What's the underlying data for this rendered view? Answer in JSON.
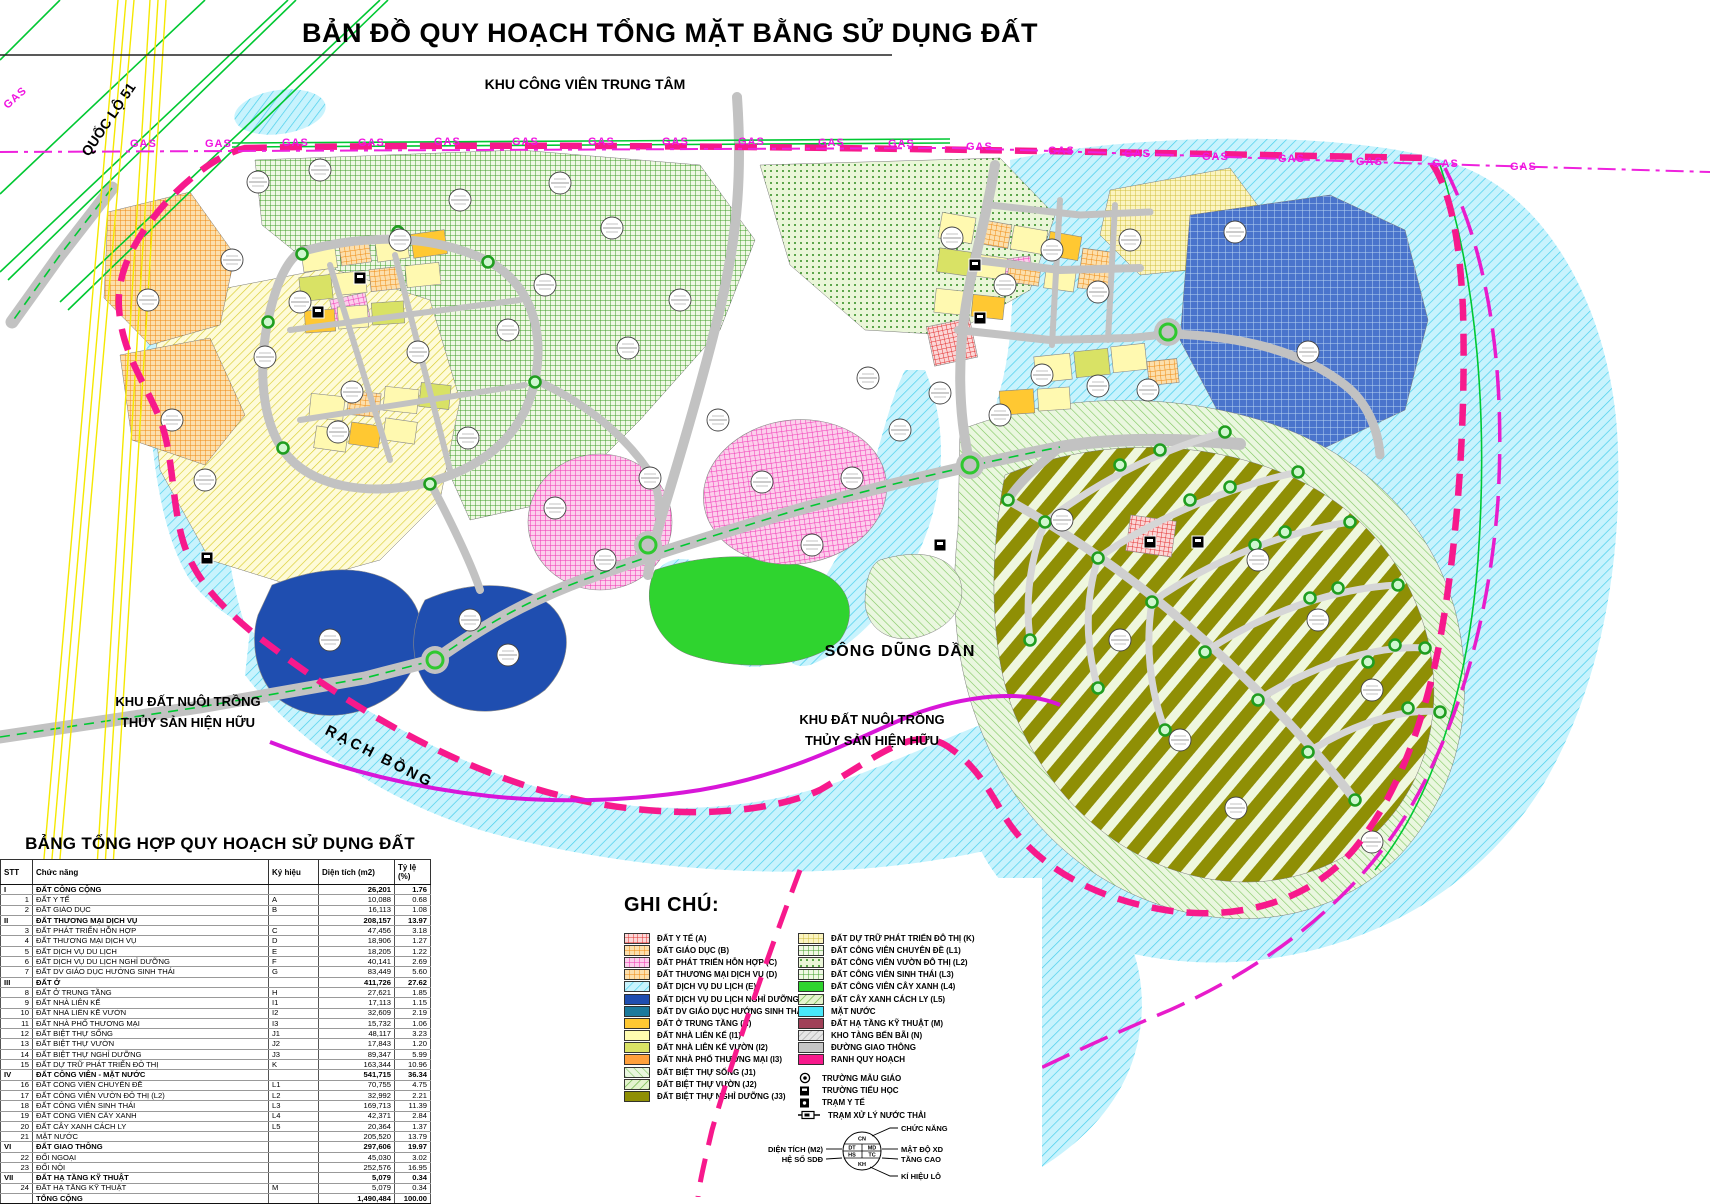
{
  "title": "BẢN ĐỒ QUY HOẠCH TỔNG MẶT BẰNG SỬ DỤNG ĐẤT",
  "map": {
    "labels": {
      "top_area": "KHU CÔNG VIÊN TRUNG TÂM",
      "highway": "QUỐC LỘ 51",
      "gas": "GAS",
      "river": "SÔNG DŨNG DẦN",
      "aquaculture_line1": "KHU ĐẤT NUÔI TRỒNG",
      "aquaculture_line2": "THỦY SẢN HIỆN HỮU",
      "creek": "RẠCH BỒNG"
    },
    "colors": {
      "boundary_pink": "#F7198C",
      "gas_magenta": "#F014E0",
      "water_cyan": "#C8F3FD",
      "road_gray": "#C2C2C2",
      "highway_green": "#00C832",
      "resort_olive": "#8F8F05",
      "deep_blue": "#1F4EB0"
    }
  },
  "table": {
    "title": "BẢNG TỔNG HỢP QUY HOẠCH SỬ DỤNG ĐẤT",
    "columns": [
      "STT",
      "Chức năng",
      "Ký hiệu",
      "Diện tích (m2)",
      "Tỷ lệ (%)"
    ],
    "rows": [
      {
        "stt": "I",
        "name": "ĐẤT CÔNG CỘNG",
        "sym": "",
        "area": "26,201",
        "pct": "1.76",
        "group": true
      },
      {
        "stt": "1",
        "name": "ĐẤT Y TẾ",
        "sym": "A",
        "area": "10,088",
        "pct": "0.68"
      },
      {
        "stt": "2",
        "name": "ĐẤT GIÁO DỤC",
        "sym": "B",
        "area": "16,113",
        "pct": "1.08"
      },
      {
        "stt": "II",
        "name": "ĐẤT THƯƠNG MẠI DỊCH VỤ",
        "sym": "",
        "area": "208,157",
        "pct": "13.97",
        "group": true
      },
      {
        "stt": "3",
        "name": "ĐẤT PHÁT TRIỂN HỖN HỢP",
        "sym": "C",
        "area": "47,456",
        "pct": "3.18"
      },
      {
        "stt": "4",
        "name": "ĐẤT THƯƠNG MẠI DỊCH VỤ",
        "sym": "D",
        "area": "18,906",
        "pct": "1.27"
      },
      {
        "stt": "5",
        "name": "ĐẤT DỊCH VỤ DU LỊCH",
        "sym": "E",
        "area": "18,205",
        "pct": "1.22"
      },
      {
        "stt": "6",
        "name": "ĐẤT DỊCH VỤ DU LỊCH NGHỈ DƯỠNG",
        "sym": "F",
        "area": "40,141",
        "pct": "2.69"
      },
      {
        "stt": "7",
        "name": "ĐẤT DV GIÁO DỤC HƯỚNG SINH THÁI",
        "sym": "G",
        "area": "83,449",
        "pct": "5.60"
      },
      {
        "stt": "III",
        "name": "ĐẤT Ở",
        "sym": "",
        "area": "411,726",
        "pct": "27.62",
        "group": true
      },
      {
        "stt": "8",
        "name": "ĐẤT Ở TRUNG TẦNG",
        "sym": "H",
        "area": "27,621",
        "pct": "1.85"
      },
      {
        "stt": "9",
        "name": "ĐẤT NHÀ LIÊN KẾ",
        "sym": "I1",
        "area": "17,113",
        "pct": "1.15"
      },
      {
        "stt": "10",
        "name": "ĐẤT NHÀ LIÊN KẾ VƯỜN",
        "sym": "I2",
        "area": "32,609",
        "pct": "2.19"
      },
      {
        "stt": "11",
        "name": "ĐẤT NHÀ PHỐ THƯƠNG MẠI",
        "sym": "I3",
        "area": "15,732",
        "pct": "1.06"
      },
      {
        "stt": "12",
        "name": "ĐẤT BIỆT THỰ SỐNG",
        "sym": "J1",
        "area": "48,117",
        "pct": "3.23"
      },
      {
        "stt": "13",
        "name": "ĐẤT BIỆT THỰ VƯỜN",
        "sym": "J2",
        "area": "17,843",
        "pct": "1.20"
      },
      {
        "stt": "14",
        "name": "ĐẤT BIỆT THỰ NGHỈ DƯỠNG",
        "sym": "J3",
        "area": "89,347",
        "pct": "5.99"
      },
      {
        "stt": "15",
        "name": "ĐẤT DỰ TRỮ PHÁT TRIỂN ĐÔ THỊ",
        "sym": "K",
        "area": "163,344",
        "pct": "10.96"
      },
      {
        "stt": "IV",
        "name": "ĐẤT CÔNG VIÊN - MẶT NƯỚC",
        "sym": "",
        "area": "541,715",
        "pct": "36.34",
        "group": true
      },
      {
        "stt": "16",
        "name": "ĐẤT CÔNG VIÊN CHUYÊN ĐỀ",
        "sym": "L1",
        "area": "70,755",
        "pct": "4.75"
      },
      {
        "stt": "17",
        "name": "ĐẤT CÔNG VIÊN VƯỜN ĐÔ THỊ (L2)",
        "sym": "L2",
        "area": "32,992",
        "pct": "2.21"
      },
      {
        "stt": "18",
        "name": "ĐẤT CÔNG VIÊN SINH THÁI",
        "sym": "L3",
        "area": "169,713",
        "pct": "11.39"
      },
      {
        "stt": "19",
        "name": "ĐẤT CÔNG VIÊN CÂY XANH",
        "sym": "L4",
        "area": "42,371",
        "pct": "2.84"
      },
      {
        "stt": "20",
        "name": "ĐẤT CÂY XANH CÁCH LY",
        "sym": "L5",
        "area": "20,364",
        "pct": "1.37"
      },
      {
        "stt": "21",
        "name": "MẶT NƯỚC",
        "sym": "",
        "area": "205,520",
        "pct": "13.79"
      },
      {
        "stt": "VI",
        "name": "ĐẤT GIAO THÔNG",
        "sym": "",
        "area": "297,606",
        "pct": "19.97",
        "group": true
      },
      {
        "stt": "22",
        "name": "ĐỐI NGOẠI",
        "sym": "",
        "area": "45,030",
        "pct": "3.02"
      },
      {
        "stt": "23",
        "name": "ĐỐI NỘI",
        "sym": "",
        "area": "252,576",
        "pct": "16.95"
      },
      {
        "stt": "VII",
        "name": "ĐẤT HẠ TẦNG KỸ THUẬT",
        "sym": "",
        "area": "5,079",
        "pct": "0.34",
        "group": true
      },
      {
        "stt": "24",
        "name": "ĐẤT HẠ TẦNG KỸ THUẬT",
        "sym": "M",
        "area": "5,079",
        "pct": "0.34"
      },
      {
        "stt": "",
        "name": "TỔNG CỘNG",
        "sym": "",
        "area": "1,490,484",
        "pct": "100.00",
        "group": true,
        "total": true
      }
    ]
  },
  "legend": {
    "title": "GHI CHÚ:",
    "left": [
      {
        "label": "ĐẤT Y TẾ (A)",
        "swatch": "pRed"
      },
      {
        "label": "ĐẤT GIÁO DỤC (B)",
        "swatch": "pOrange"
      },
      {
        "label": "ĐẤT PHÁT TRIỂN HỖN HỢP (C)",
        "swatch": "pPink"
      },
      {
        "label": "ĐẤT THƯƠNG MẠI DỊCH VỤ (D)",
        "swatch": "pOrange"
      },
      {
        "label": "ĐẤT DỊCH VỤ DU LỊCH (E)",
        "swatch": "pWater"
      },
      {
        "label": "ĐẤT DỊCH VỤ DU LỊCH NGHỈ DƯỠNG (F)",
        "swatch": "#1F4EB0"
      },
      {
        "label": "ĐẤT DV GIÁO DỤC HƯỚNG SINH THÁI (G)",
        "swatch": "#1C7A9C"
      },
      {
        "label": "ĐẤT Ở TRUNG TẦNG (H)",
        "swatch": "#FFC832"
      },
      {
        "label": "ĐẤT NHÀ LIÊN KẾ (I1)",
        "swatch": "#FFFCB0"
      },
      {
        "label": "ĐẤT NHÀ LIÊN KẾ VƯỜN (I2)",
        "swatch": "#D9E265"
      },
      {
        "label": "ĐẤT NHÀ PHỐ THƯƠNG MẠI (I3)",
        "swatch": "#FFA03C"
      },
      {
        "label": "ĐẤT BIỆT THỰ SỐNG (J1)",
        "swatch": "pLtGreen"
      },
      {
        "label": "ĐẤT BIỆT THỰ VƯỜN (J2)",
        "swatch": "pGreenDiag"
      },
      {
        "label": "ĐẤT BIỆT THỰ NGHỈ DƯỠNG (J3)",
        "swatch": "#8F8F05"
      }
    ],
    "right": [
      {
        "label": "ĐẤT DỰ TRỮ PHÁT TRIỂN ĐÔ THỊ (K)",
        "swatch": "pYellowCross"
      },
      {
        "label": "ĐẤT CÔNG VIÊN CHUYÊN ĐỀ (L1)",
        "swatch": "pGreenCross"
      },
      {
        "label": "ĐẤT CÔNG VIÊN VƯỜN ĐÔ THỊ (L2)",
        "swatch": "pGreenDot"
      },
      {
        "label": "ĐẤT CÔNG VIÊN SINH THÁI (L3)",
        "swatch": "pGreenCross"
      },
      {
        "label": "ĐẤT CÔNG VIÊN CÂY XANH  (L4)",
        "swatch": "#2FD42F"
      },
      {
        "label": "ĐẤT CÂY XANH CÁCH LY (L5)",
        "swatch": "pGreenDiag"
      },
      {
        "label": "MẶT NƯỚC",
        "swatch": "#49E8FA"
      },
      {
        "label": "ĐẤT HẠ TẦNG KỸ THUẬT (M)",
        "swatch": "#A04058"
      },
      {
        "label": "KHO TÀNG BẾN BÃI  (N)",
        "swatch": "pGrayHatch"
      },
      {
        "label": "ĐƯỜNG GIAO THÔNG",
        "swatch": "#C6C6C6"
      },
      {
        "label": "RANH QUY HOẠCH",
        "swatch": "#F7198C"
      }
    ],
    "symbols": [
      {
        "label": "TRƯỜNG MẪU GIÁO",
        "icon": "circle-dot"
      },
      {
        "label": "TRƯỜNG TIỂU HỌC",
        "icon": "square"
      },
      {
        "label": "TRẠM Y TẾ",
        "icon": "square-dot"
      },
      {
        "label": "TRẠM XỬ LÝ NƯỚC THẢI",
        "icon": "treatment"
      }
    ],
    "diagram": {
      "cells": {
        "top": "CN",
        "mid_left": "DT",
        "mid_right": "MD",
        "low_left": "HS",
        "low_right": "TC",
        "bottom": "KH"
      },
      "labels": {
        "top": "CHỨC NĂNG",
        "mid_right": "MẬT ĐỘ XD",
        "low_right": "TẦNG CAO",
        "bottom": "KÍ HIỆU LÔ",
        "mid_left": "DIỆN TÍCH (M2)",
        "low_left": "HỆ SỐ SDĐ"
      }
    }
  }
}
